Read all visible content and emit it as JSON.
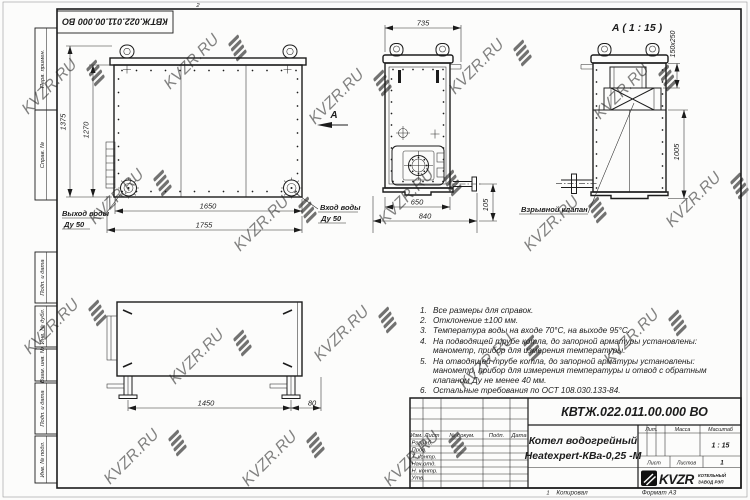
{
  "watermark": {
    "text": "KVZR.RU"
  },
  "corner_stamp": {
    "doc_number": "КВТЖ.022.011.00.000 ВО"
  },
  "frame_fields": {
    "perv_primen": "Перв. примен.",
    "sprav_no": "Справ. №",
    "podp_data_1": "Подп. и дата",
    "inv_dubl": "Инв. № дубл.",
    "vzam_inv": "Взам. инв. №",
    "podp_data_2": "Подп. и дата",
    "inv_podl": "Инв. № подл.",
    "fold_mark_top": "2",
    "fold_mark_bottom": "1"
  },
  "front_view": {
    "dim_height_outer": "1375",
    "dim_height_inner": "1270",
    "dim_width_inner": "1650",
    "dim_width_outer": "1755",
    "outlet_label_1": "Выход воды",
    "outlet_label_2": "Ду 50",
    "inlet_label_1": "Вход воды",
    "inlet_label_2": "Ду 50",
    "section_arrow": "А"
  },
  "rear_view": {
    "dim_width_top": "735",
    "dim_width_inner": "650",
    "dim_width_outer": "840",
    "dim_stub_height": "105"
  },
  "side_view": {
    "title": "А ( 1 : 15 )",
    "dim_valve": "150x250",
    "dim_height": "1005",
    "valve_label": "Взрывной клапан"
  },
  "bottom_view": {
    "dim_leg_span": "1450",
    "dim_leg_offset": "80"
  },
  "notes": {
    "items": [
      {
        "num": "1.",
        "text": "Все размеры для справок."
      },
      {
        "num": "2.",
        "text": "Отклонение ±100 мм."
      },
      {
        "num": "3.",
        "text": "Температура воды на входе 70°С, на выходе 95°С."
      },
      {
        "num": "4.",
        "text": "На подводящей трубе котла, до запорной арматуры установлены: манометр, прибор для измерения температуры."
      },
      {
        "num": "5.",
        "text": "На отводящей трубе котла, до запорной арматуры установлены: манометр, прибор для измерения температуры и отвод с обратным клапаном Ду не менее 40 мм."
      },
      {
        "num": "6.",
        "text": "Остальные требования по ОСТ 108.030.133-84."
      }
    ]
  },
  "title_block": {
    "doc_number": "КВТЖ.022.011.00.000 ВО",
    "title_line1": "Котел водогрейный",
    "title_line2": "Heatexpert-КВа-0,25 -М",
    "col_izm": "Изм.",
    "col_list": "Лист",
    "col_doc": "№ докум.",
    "col_podp": "Подп.",
    "col_data": "Дата",
    "row_razrab": "Разраб.",
    "row_prov": "Пров.",
    "row_t_kontr": "Т. контр.",
    "row_nach_otd": "Нач.отд.",
    "row_n_kontr": "Н. контр.",
    "row_utv": "Утв.",
    "lit_label": "Лит.",
    "massa_label": "Масса",
    "masshtab_label": "Масштаб",
    "scale_value": "1 : 15",
    "list_label": "Лист",
    "listov_label": "Листов",
    "listov_value": "1",
    "logo_text": "KVZR",
    "logo_sub1": "КОТЕЛЬНЫЙ",
    "logo_sub2": "ЗАВОД РЭП",
    "kopiroval": "Копировал",
    "format": "Формат А3"
  }
}
